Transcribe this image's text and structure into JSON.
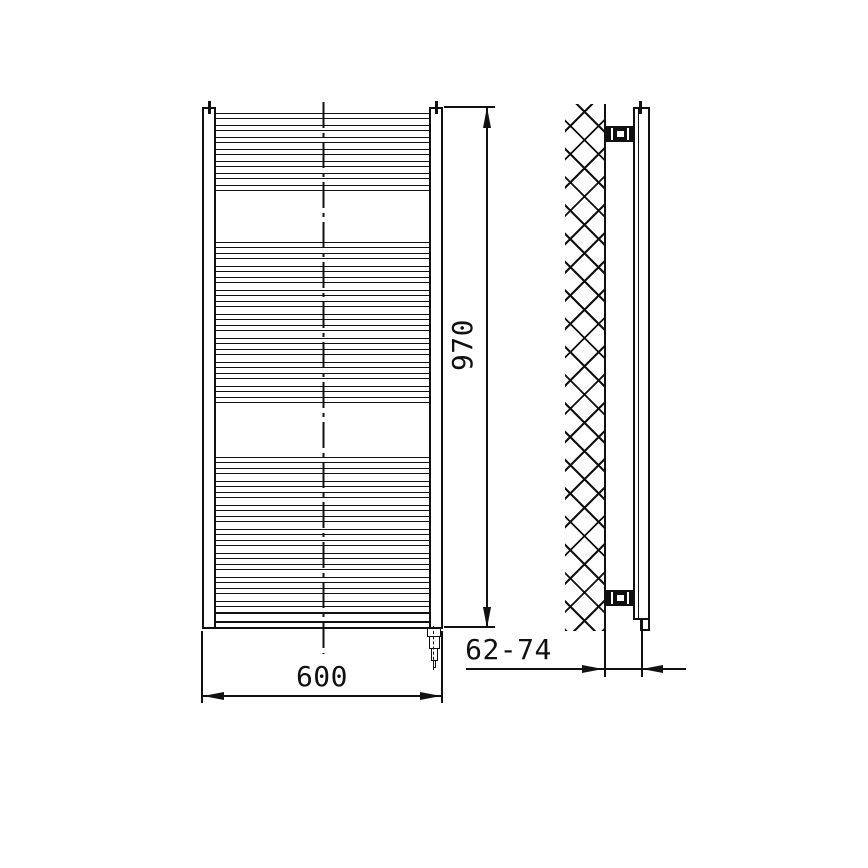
{
  "drawing_labels": {
    "height_dimension": "970",
    "width_dimension": "600",
    "wall_distance_dimension": "62-74"
  },
  "colors": {
    "line": "#111111",
    "background": "#ffffff"
  },
  "geometry": {
    "front_view": {
      "x": 202,
      "y": 107,
      "width": 241,
      "height": 522,
      "collector_width": 14,
      "rung_height": 6,
      "rungs_y": [
        113,
        125,
        137,
        149,
        161,
        173,
        185,
        242,
        253,
        266,
        277,
        290,
        301,
        314,
        325,
        338,
        349,
        362,
        373,
        386,
        397,
        457,
        468,
        481,
        492,
        505,
        516,
        529,
        540,
        553,
        564,
        577,
        588,
        601
      ],
      "header_band_y": 612,
      "bottom_edge_y": 627,
      "axis_x": 322.5,
      "vent_plug_centers_x": [
        209,
        436
      ],
      "element_center_x": 434
    },
    "side_view": {
      "wall_hatch": {
        "x": 565,
        "y": 104,
        "width": 39,
        "height": 527
      },
      "wall_face_x": 604,
      "tube_x": 633,
      "tube_width": 17,
      "bracket_y": [
        126,
        590
      ],
      "vent_plug_center_x": 640.5
    },
    "dimension_lines": {
      "height": {
        "line_x": 487,
        "from_y": 107,
        "to_y": 628
      },
      "width": {
        "line_y": 696,
        "from_x": 202,
        "to_x": 443
      },
      "depth": {
        "line_y": 669,
        "tip1_x": 604,
        "tip2_x": 642
      }
    }
  }
}
